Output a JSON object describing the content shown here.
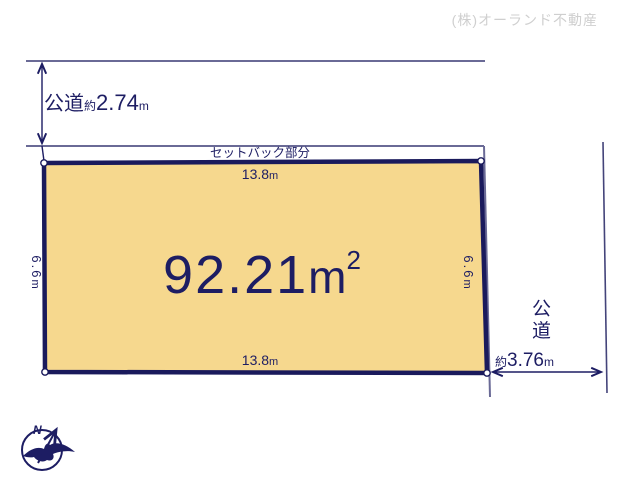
{
  "colors": {
    "navy": "#1D1D63",
    "plot_fill": "#F6D88E",
    "plot_stroke": "#1A1A5C",
    "thin_line": "#6A6A96",
    "road_line": "#44447A",
    "company_gray": "#CFCFCF"
  },
  "company_credit": "(株)オーランド不動産",
  "top_road": {
    "label": "公道",
    "approx_prefix": "約",
    "value": "2.74",
    "unit": "m"
  },
  "setback": {
    "label": "セットバック部分"
  },
  "plot": {
    "area": {
      "value": "92.21",
      "unit": "m",
      "exponent": "2"
    },
    "top_width": {
      "value": "13.8",
      "unit": "m"
    },
    "bottom_width": {
      "value": "13.8",
      "unit": "m"
    },
    "left_depth": {
      "value": "6.6",
      "unit": "m"
    },
    "right_depth": {
      "value": "6.6",
      "unit": "m"
    }
  },
  "right_road": {
    "label": "公道",
    "approx_prefix": "約",
    "value": "3.76",
    "unit": "m"
  },
  "compass": {
    "label": "N"
  }
}
